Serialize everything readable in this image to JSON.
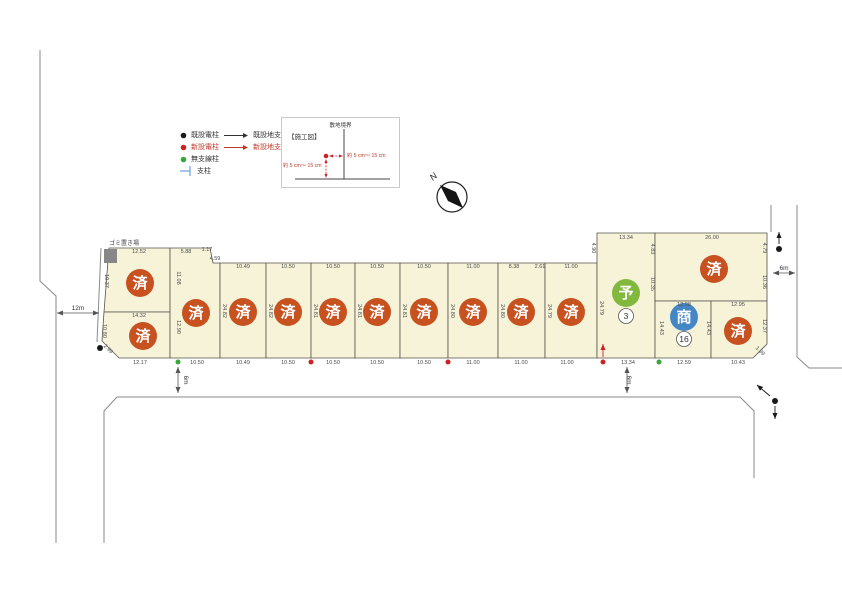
{
  "legend": {
    "rows": [
      {
        "dot_color": "#1a1a1a",
        "label": "既設電柱",
        "arrow_color": "#333333",
        "arrow_label": "既設地支線"
      },
      {
        "dot_color": "#cc2222",
        "label": "新設電柱",
        "arrow_color": "#c0392b",
        "arrow_label": "新設地支線"
      },
      {
        "dot_color": "#3aa53f",
        "label": "無支線柱"
      },
      {
        "symbol": "support-pole-symbol",
        "symbol_color": "#6f9fd8",
        "label": "支柱"
      }
    ],
    "accent_red": "#c0392b"
  },
  "detail_box": {
    "title": "【施工図】",
    "boundary_label": "敷地境界",
    "note_right": "約 5 cm〜 15 cm",
    "note_left": "約 5 cm〜 15 cm"
  },
  "compass": {
    "label": "N"
  },
  "map": {
    "status_colors": {
      "sold": "#c7511f",
      "reserved": "#83b83e",
      "commercial": "#4587c5"
    },
    "pole_colors": {
      "black": "#1a1a1a",
      "red": "#cc2222",
      "green": "#3aa53f"
    },
    "waste_area": {
      "label": "ゴミ置き場",
      "x": 104,
      "y": 249,
      "w": 13,
      "h": 14,
      "color": "#878787"
    },
    "roads": [
      "M 40,50 L 40,281 L 56,296 L 56,543",
      "M 101,248 L 97,342",
      "M 104,543 L 104,411 L 117,397 L 740,397 L 754,411 L 754,478",
      "M 771,205 L 771,232",
      "M 797,205 L 797,357 L 809,368 L 842,368"
    ],
    "plots": [
      {
        "name": "plot-01",
        "status": "sold",
        "marker": "済",
        "points": "109,248 170,248 170,312 104,312",
        "cx": 140,
        "cy": 283
      },
      {
        "name": "plot-02",
        "status": "sold",
        "marker": "済",
        "points": "104,312 170,312 170,358 119,358 102,341",
        "cx": 143,
        "cy": 336
      },
      {
        "name": "plot-03",
        "status": "sold",
        "marker": "済",
        "points": "170,248 210,248 213,263 220,263 220,358 170,358",
        "cx": 196,
        "cy": 313
      },
      {
        "name": "plot-04",
        "status": "sold",
        "marker": "済",
        "points": "220,263 266,263 266,358 220,358",
        "cx": 243,
        "cy": 312
      },
      {
        "name": "plot-05",
        "status": "sold",
        "marker": "済",
        "points": "266,263 311,263 311,358 266,358",
        "cx": 288,
        "cy": 312
      },
      {
        "name": "plot-06",
        "status": "sold",
        "marker": "済",
        "points": "311,263 355,263 355,358 311,358",
        "cx": 333,
        "cy": 312
      },
      {
        "name": "plot-07",
        "status": "sold",
        "marker": "済",
        "points": "355,263 400,263 400,358 355,358",
        "cx": 377,
        "cy": 312
      },
      {
        "name": "plot-08",
        "status": "sold",
        "marker": "済",
        "points": "400,263 448,263 448,358 400,358",
        "cx": 424,
        "cy": 312
      },
      {
        "name": "plot-09",
        "status": "sold",
        "marker": "済",
        "points": "448,263 498,263 498,358 448,358",
        "cx": 473,
        "cy": 312
      },
      {
        "name": "plot-10",
        "status": "sold",
        "marker": "済",
        "points": "498,263 545,263 545,358 498,358",
        "cx": 521,
        "cy": 312
      },
      {
        "name": "plot-11",
        "status": "sold",
        "marker": "済",
        "points": "545,263 597,263 597,358 545,358",
        "cx": 571,
        "cy": 312
      },
      {
        "name": "plot-12",
        "status": "reserved",
        "marker": "予",
        "badge": "3",
        "points": "597,233 655,233 655,358 597,358",
        "cx": 626,
        "cy": 293,
        "bx": 626,
        "by": 316
      },
      {
        "name": "plot-13",
        "status": "sold",
        "marker": "済",
        "points": "655,233 767,233 767,301 655,301",
        "cx": 714,
        "cy": 269
      },
      {
        "name": "plot-14",
        "status": "commercial",
        "marker": "商",
        "badge": "16",
        "points": "655,301 711,301 711,358 655,358",
        "cx": 684,
        "cy": 317,
        "bx": 684,
        "by": 339
      },
      {
        "name": "plot-15",
        "status": "sold",
        "marker": "済",
        "points": "711,301 767,301 767,344 753,358 711,358",
        "cx": 738,
        "cy": 331
      }
    ],
    "dim_labels": [
      {
        "t": "12.52",
        "x": 139,
        "y": 253
      },
      {
        "t": "5.88",
        "x": 186,
        "y": 253
      },
      {
        "t": "1.17",
        "x": 207,
        "y": 251
      },
      {
        "t": "4.59",
        "x": 215,
        "y": 260
      },
      {
        "t": "10.49",
        "x": 243,
        "y": 268
      },
      {
        "t": "10.50",
        "x": 288,
        "y": 268
      },
      {
        "t": "10.50",
        "x": 333,
        "y": 268
      },
      {
        "t": "10.50",
        "x": 377,
        "y": 268
      },
      {
        "t": "10.50",
        "x": 424,
        "y": 268
      },
      {
        "t": "11.00",
        "x": 473,
        "y": 268
      },
      {
        "t": "8.38",
        "x": 514,
        "y": 268
      },
      {
        "t": "2.61",
        "x": 540,
        "y": 268
      },
      {
        "t": "11.00",
        "x": 571,
        "y": 268
      },
      {
        "t": "13.34",
        "x": 626,
        "y": 239
      },
      {
        "t": "26.00",
        "x": 712,
        "y": 239
      },
      {
        "t": "14.32",
        "x": 139,
        "y": 317
      },
      {
        "t": "12.98",
        "x": 684,
        "y": 306
      },
      {
        "t": "12.95",
        "x": 738,
        "y": 306
      },
      {
        "t": "12.17",
        "x": 140,
        "y": 364
      },
      {
        "t": "10.50",
        "x": 197,
        "y": 364
      },
      {
        "t": "10.49",
        "x": 243,
        "y": 364
      },
      {
        "t": "10.50",
        "x": 288,
        "y": 364
      },
      {
        "t": "10.50",
        "x": 333,
        "y": 364
      },
      {
        "t": "10.50",
        "x": 377,
        "y": 364
      },
      {
        "t": "10.50",
        "x": 424,
        "y": 364
      },
      {
        "t": "11.00",
        "x": 473,
        "y": 364
      },
      {
        "t": "11.00",
        "x": 521,
        "y": 364
      },
      {
        "t": "11.00",
        "x": 567,
        "y": 364
      },
      {
        "t": "13.34",
        "x": 628,
        "y": 364
      },
      {
        "t": "12.59",
        "x": 684,
        "y": 364
      },
      {
        "t": "10.43",
        "x": 738,
        "y": 364
      },
      {
        "t": "10.37",
        "x": 105,
        "y": 281,
        "r": 90
      },
      {
        "t": "10.80",
        "x": 103,
        "y": 331,
        "r": 90
      },
      {
        "t": "11.08",
        "x": 177,
        "y": 278,
        "r": 90
      },
      {
        "t": "12.90",
        "x": 177,
        "y": 327,
        "r": 90
      },
      {
        "t": "24.82",
        "x": 223,
        "y": 311,
        "r": 90
      },
      {
        "t": "24.82",
        "x": 269,
        "y": 311,
        "r": 90
      },
      {
        "t": "24.81",
        "x": 314,
        "y": 311,
        "r": 90
      },
      {
        "t": "24.81",
        "x": 358,
        "y": 311,
        "r": 90
      },
      {
        "t": "24.81",
        "x": 403,
        "y": 311,
        "r": 90
      },
      {
        "t": "24.80",
        "x": 451,
        "y": 311,
        "r": 90
      },
      {
        "t": "24.80",
        "x": 501,
        "y": 311,
        "r": 90
      },
      {
        "t": "24.79",
        "x": 548,
        "y": 311,
        "r": 90
      },
      {
        "t": "24.79",
        "x": 600,
        "y": 308,
        "r": 90
      },
      {
        "t": "4.90",
        "x": 592,
        "y": 248,
        "r": 90
      },
      {
        "t": "4.83",
        "x": 651,
        "y": 249,
        "r": 90
      },
      {
        "t": "10.35",
        "x": 651,
        "y": 284,
        "r": 90
      },
      {
        "t": "4.79",
        "x": 763,
        "y": 248,
        "r": 90
      },
      {
        "t": "10.36",
        "x": 763,
        "y": 282,
        "r": 90
      },
      {
        "t": "14.43",
        "x": 660,
        "y": 328,
        "r": 90
      },
      {
        "t": "14.43",
        "x": 707,
        "y": 328,
        "r": 90
      },
      {
        "t": "12.37",
        "x": 763,
        "y": 326,
        "r": 90
      },
      {
        "t": "2.99",
        "x": 107,
        "y": 350,
        "r": 45
      },
      {
        "t": "1.99",
        "x": 759,
        "y": 352,
        "r": 45
      },
      {
        "t": "12m",
        "x": 78,
        "y": 310,
        "cls": "roadlbl"
      },
      {
        "t": "6m",
        "x": 184,
        "y": 380,
        "r": 90,
        "cls": "roadlbl"
      },
      {
        "t": "6m",
        "x": 627,
        "y": 380,
        "r": 90,
        "cls": "roadlbl"
      },
      {
        "t": "6m",
        "x": 784,
        "y": 270,
        "cls": "roadlbl"
      },
      {
        "t": "ゴミ置き場",
        "x": 124,
        "y": 245,
        "cls": "small"
      }
    ],
    "measure_arrows": [
      {
        "x1": 57,
        "y1": 313,
        "x2": 99,
        "y2": 313
      },
      {
        "x1": 178,
        "y1": 367,
        "x2": 178,
        "y2": 393
      },
      {
        "x1": 627,
        "y1": 367,
        "x2": 627,
        "y2": 393
      },
      {
        "x1": 773,
        "y1": 273,
        "x2": 795,
        "y2": 273
      }
    ],
    "poles": [
      {
        "x": 100,
        "y": 348,
        "c": "black"
      },
      {
        "x": 779,
        "y": 249,
        "c": "black"
      },
      {
        "x": 775,
        "y": 401,
        "c": "black"
      },
      {
        "x": 311,
        "y": 362,
        "c": "red"
      },
      {
        "x": 448,
        "y": 362,
        "c": "red"
      },
      {
        "x": 603,
        "y": 362,
        "c": "red"
      },
      {
        "x": 178,
        "y": 362,
        "c": "green"
      },
      {
        "x": 659,
        "y": 362,
        "c": "green"
      }
    ],
    "support_arrows": [
      {
        "x1": 779,
        "y1": 244,
        "x2": 779,
        "y2": 232,
        "c": "black"
      },
      {
        "x1": 775,
        "y1": 406,
        "x2": 775,
        "y2": 419,
        "c": "black"
      },
      {
        "x1": 770,
        "y1": 396,
        "x2": 757,
        "y2": 385,
        "c": "black"
      },
      {
        "x1": 603,
        "y1": 357,
        "x2": 603,
        "y2": 344,
        "c": "red"
      }
    ]
  }
}
